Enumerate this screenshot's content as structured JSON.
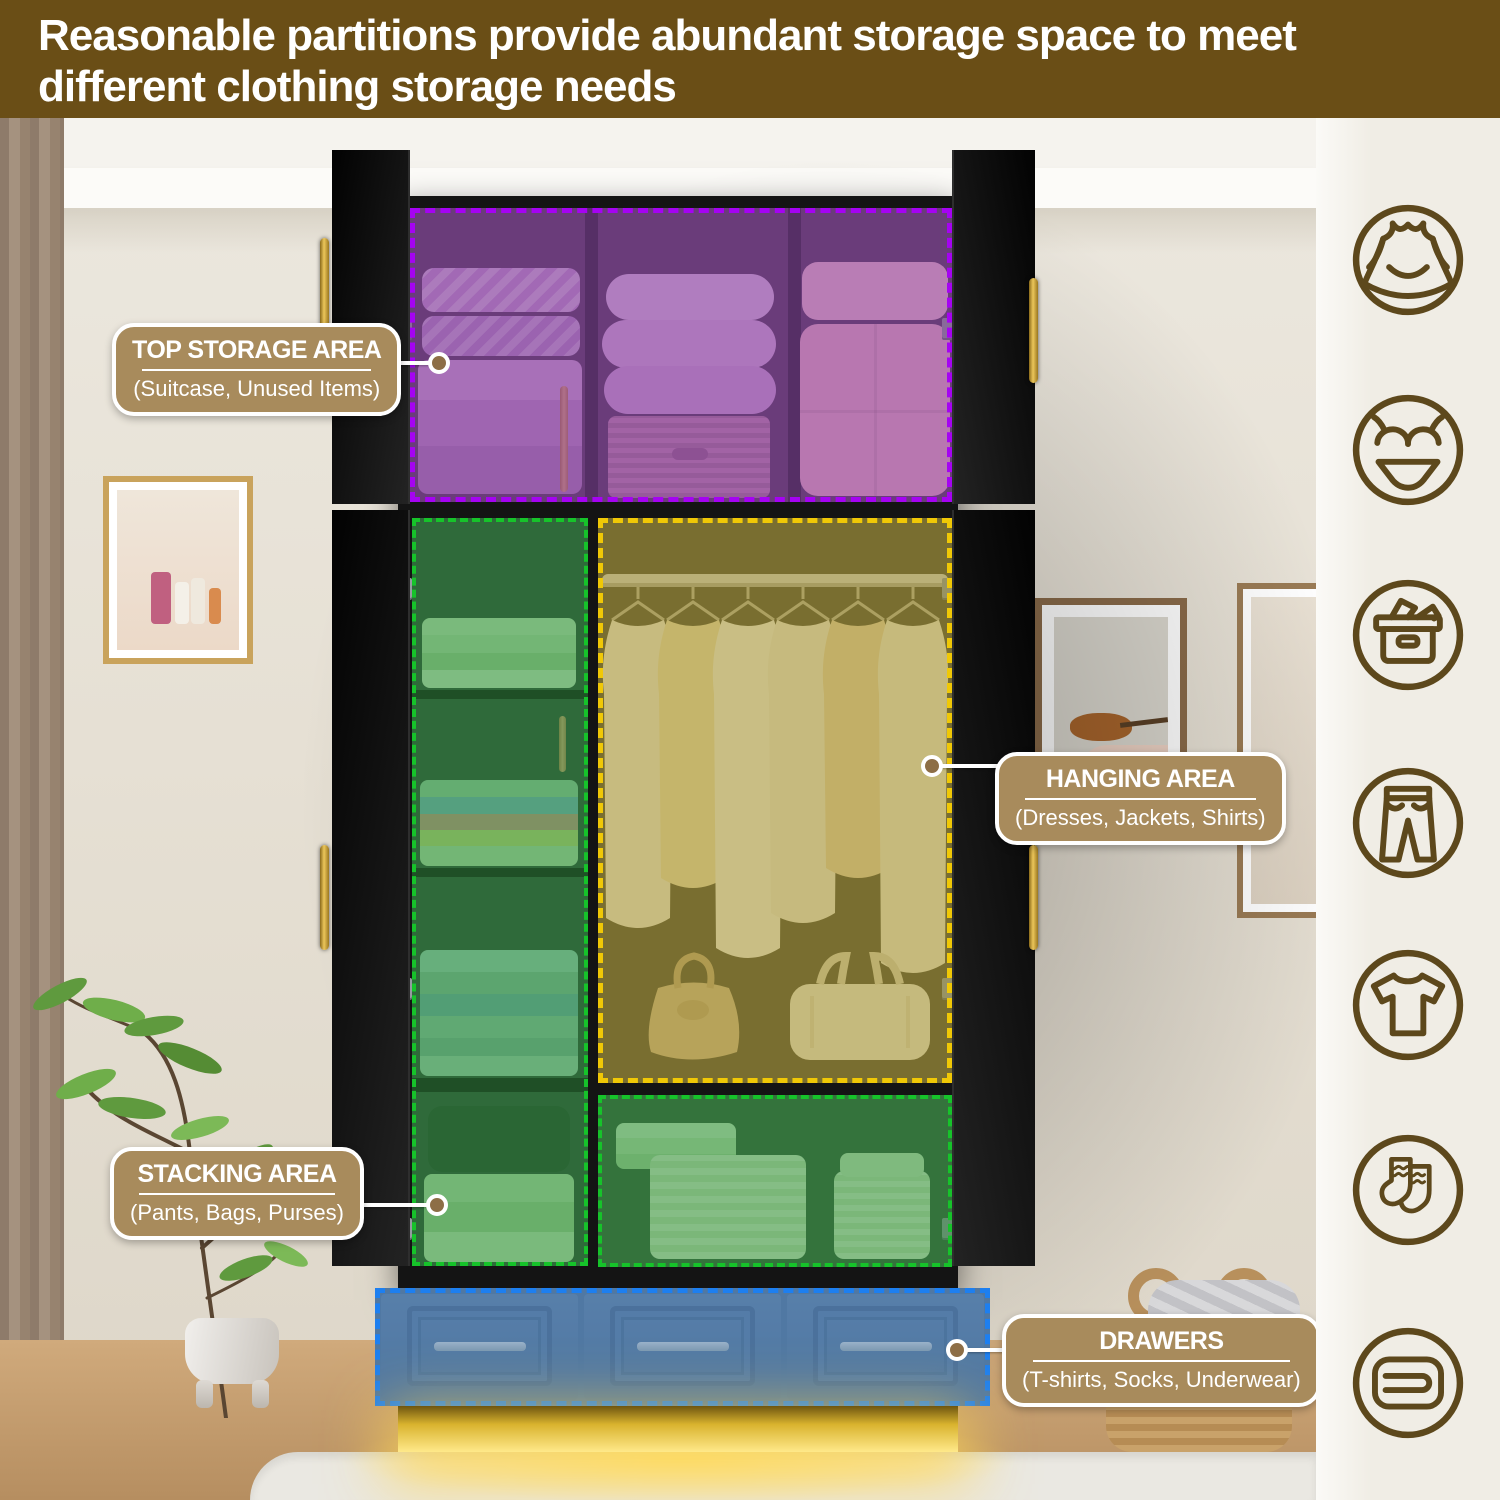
{
  "header": {
    "title": "Reasonable partitions provide abundant storage space to meet different clothing storage needs"
  },
  "callouts": {
    "top_storage": {
      "title": "TOP STORAGE AREA",
      "subtitle": "(Suitcase, Unused Items)"
    },
    "hanging": {
      "title": "HANGING AREA",
      "subtitle": "(Dresses, Jackets, Shirts)"
    },
    "stacking": {
      "title": "STACKING AREA",
      "subtitle": "(Pants, Bags, Purses)"
    },
    "drawers": {
      "title": "DRAWERS",
      "subtitle": "(T-shirts, Socks, Underwear)"
    }
  },
  "zones": [
    {
      "name": "top-storage-zone",
      "border_color": "#a503f2"
    },
    {
      "name": "stacking-zone-left",
      "border_color": "#16c32a"
    },
    {
      "name": "hanging-zone",
      "border_color": "#f0c806"
    },
    {
      "name": "stacking-zone-bottom",
      "border_color": "#16c32a"
    },
    {
      "name": "drawers-zone",
      "border_color": "#1d7ff0"
    }
  ],
  "sidebar": {
    "icons": [
      {
        "name": "dress-icon"
      },
      {
        "name": "lingerie-icon"
      },
      {
        "name": "storage-box-icon"
      },
      {
        "name": "pants-icon"
      },
      {
        "name": "tshirt-icon"
      },
      {
        "name": "socks-icon"
      },
      {
        "name": "folded-towel-icon"
      }
    ]
  },
  "css_vars": {
    "header-bg": "#6a4e16",
    "label-bg": "#a88b5c",
    "sidebar-bg": "#f0ede5",
    "icon-color": "#5d481c",
    "z-purple": "#a503f2",
    "z-purple-fill": "rgba(125,55,150,0.50)",
    "z-green": "#16c32a",
    "z-green-fill": "rgba(46,138,60,0.52)",
    "z-yellow": "#f0c806",
    "z-yellow-fill": "rgba(155,140,40,0.50)",
    "z-blue": "#1d7ff0",
    "z-blue-fill": "rgba(80,125,175,0.45)"
  }
}
